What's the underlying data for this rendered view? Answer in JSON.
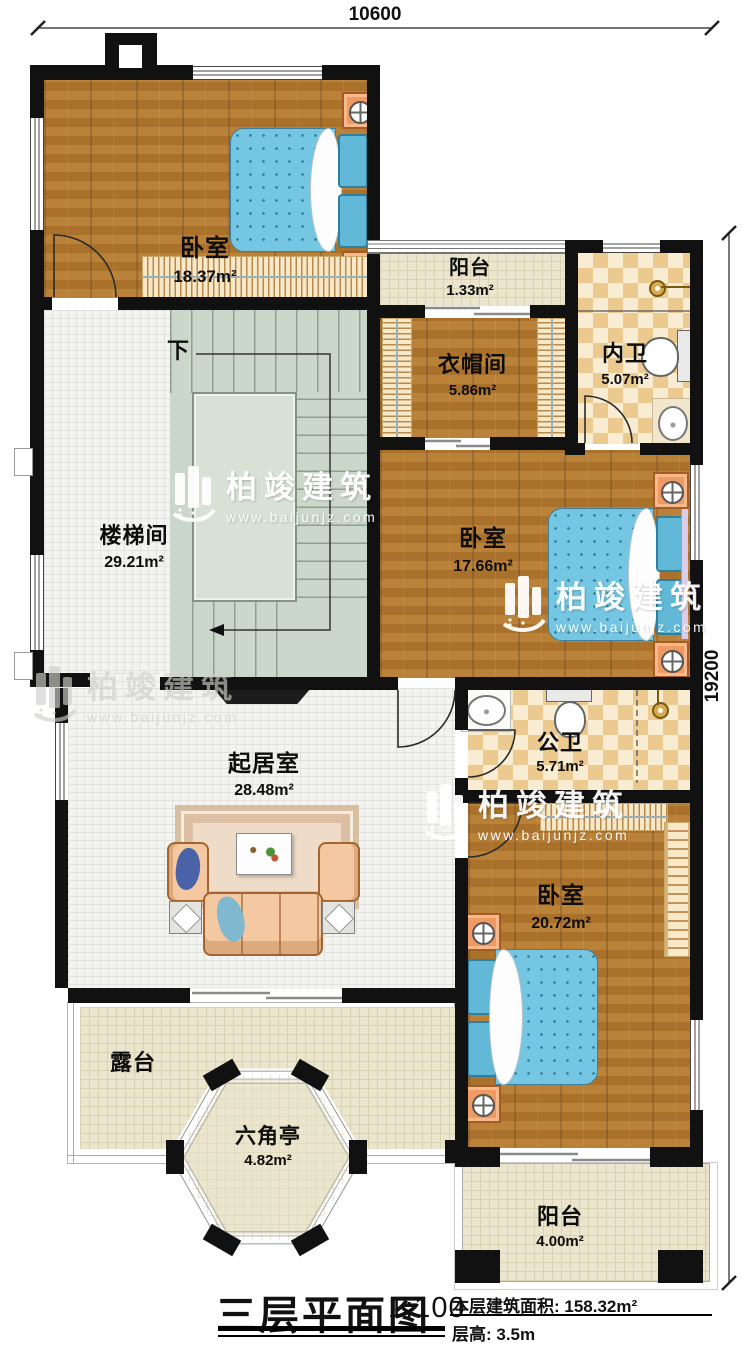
{
  "title_block": {
    "title": "三层平面图",
    "scale": "1:100",
    "area_label": "本层建筑面积: 158.32m²",
    "height_label": "层高: 3.5m"
  },
  "dimensions": {
    "width_mm": "10600",
    "height_mm": "19200"
  },
  "stairs": {
    "down_label": "下"
  },
  "watermark": {
    "brand": "柏竣建筑",
    "website": "www.baijunjz.com"
  },
  "rooms": [
    {
      "id": "bedroom-top-left",
      "name": "卧室",
      "area": "18.37m²"
    },
    {
      "id": "balcony-top",
      "name": "阳台",
      "area": "1.33m²"
    },
    {
      "id": "cloakroom",
      "name": "衣帽间",
      "area": "5.86m²"
    },
    {
      "id": "ensuite-bath",
      "name": "内卫",
      "area": "5.07m²"
    },
    {
      "id": "stairwell",
      "name": "楼梯间",
      "area": "29.21m²"
    },
    {
      "id": "bedroom-middle",
      "name": "卧室",
      "area": "17.66m²"
    },
    {
      "id": "public-bath",
      "name": "公卫",
      "area": "5.71m²"
    },
    {
      "id": "living-room",
      "name": "起居室",
      "area": "28.48m²"
    },
    {
      "id": "bedroom-bottom",
      "name": "卧室",
      "area": "20.72m²"
    },
    {
      "id": "terrace",
      "name": "露台",
      "area": ""
    },
    {
      "id": "hex-pavilion",
      "name": "六角亭",
      "area": "4.82m²"
    },
    {
      "id": "balcony-bottom",
      "name": "阳台",
      "area": "4.00m²"
    }
  ],
  "colors": {
    "wall": "#111111",
    "wood_floor": "#b3782f",
    "tile_dark": "#ecc98f",
    "tile_light": "#f8ecd2",
    "bed_blue": "#74c6e2",
    "accent_orange": "#ef9a62",
    "terrace_cream": "#eae5cc",
    "stair_green": "#ccd7cb"
  }
}
